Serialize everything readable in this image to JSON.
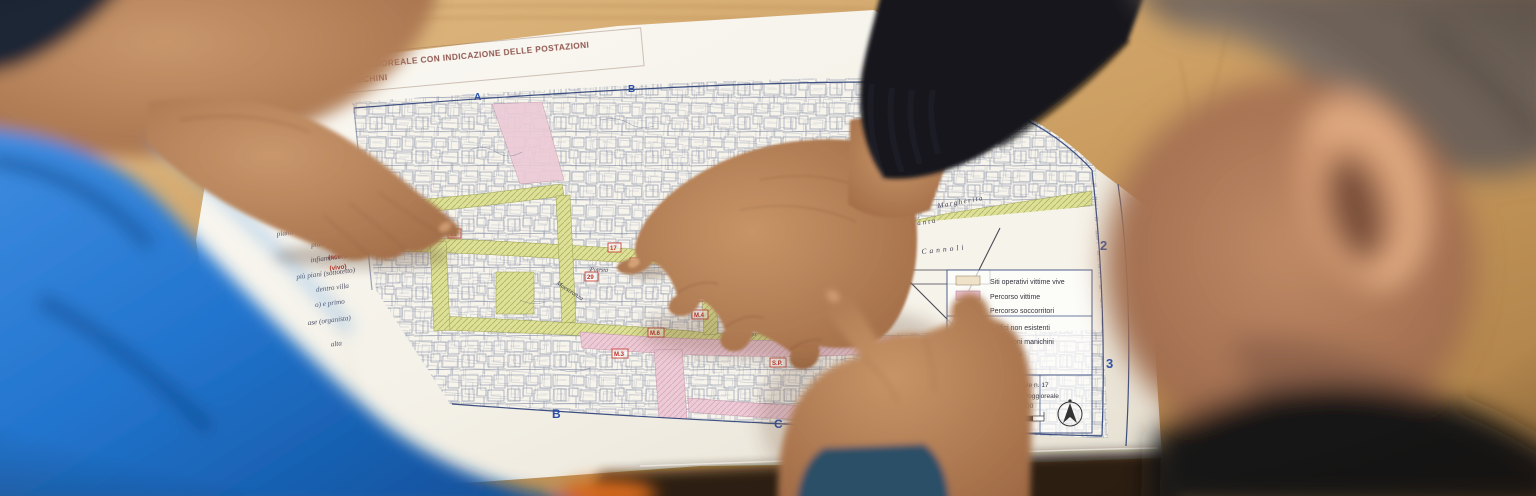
{
  "map": {
    "title_line1": "PLANIMETRIA SITI POGGIOREALE CON INDICAZIONE DELLE POSTAZIONI",
    "title_line2": "VITTIME VIVE E MANICHINI",
    "grid_labels": {
      "top_a": "A",
      "top_b": "B",
      "right_2": "2",
      "right_3": "3",
      "bottom_b": "B",
      "bottom_c": "C",
      "bottom_d": "D"
    },
    "legend": {
      "items": [
        {
          "label": "Siti operativi vittime vive",
          "swatch": "#efe2c8"
        },
        {
          "label": "Percorso vittime",
          "swatch": "#e9c0cd"
        },
        {
          "label": "Percorso soccorritori",
          "swatch": "#dde096"
        },
        {
          "label": "Edifici non esistenti",
          "swatch": "#ffffff"
        },
        {
          "label": "Postazioni manichini",
          "swatch": "#dfe8f2"
        },
        {
          "label": "Dispositivi",
          "swatch": "#ffffff"
        },
        {
          "label": "“…nPark”",
          "swatch": "#ffffff"
        }
      ],
      "cartouche": [
        "Foglio catastale  n. 17",
        "Comune di Poggioreale",
        "scala 1:1000"
      ]
    },
    "streets": [
      "Margherita",
      "Santa",
      "Largo  Cannoli",
      "Purgatorio",
      "Maestranza",
      "Fonte C.",
      "Potestà",
      "Corso",
      "Alberga",
      "Vittoria"
    ],
    "markers": [
      "21",
      "31",
      "17",
      "29",
      "11",
      "13",
      "23",
      "24",
      "M.1",
      "M.4",
      "M.6",
      "22",
      "F.P.",
      "S.P.",
      "M.3"
    ],
    "margin_notes": [
      "chiese/bar piante",
      "chiesa piante",
      "piano terra (vivi) vecchio",
      "piano terra",
      "infiammabili",
      "più piani (sottotetto)",
      "dentro villa",
      "o) e primo",
      "ase (organista)",
      "alta"
    ],
    "red_note": [
      "Ingresso",
      "(scena lab)",
      "(vivo)"
    ]
  },
  "colors": {
    "wood": "#c69a5f",
    "paper": "#f6f3ec",
    "street_green": "#dde096",
    "street_pink": "#eccad6",
    "marker_red": "#c23127",
    "grid_blue": "#2b4ea8",
    "building_ink": "#6b7795",
    "shirt_blue": "#2274cd",
    "sleeve_black": "#17171d",
    "cuff_teal": "#2a4f66",
    "skin": "#b57c55",
    "hair_gray": "#6e6258"
  },
  "icons": [
    "compass-rose-icon",
    "scale-bar-icon",
    "north-arrow-icon"
  ]
}
